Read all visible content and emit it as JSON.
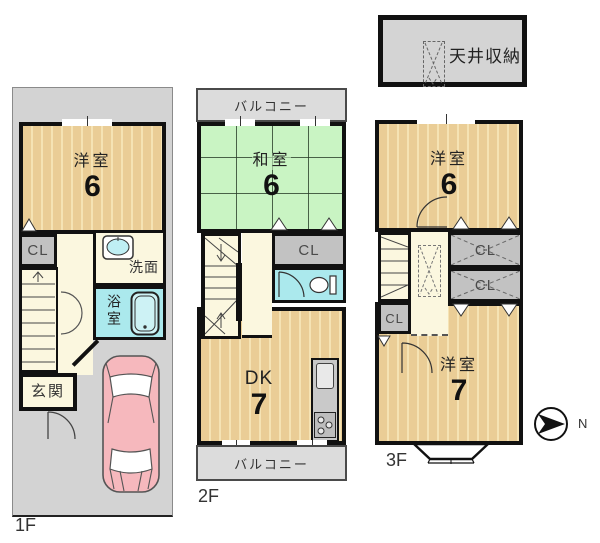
{
  "f1": {
    "label": "1F",
    "western_room": {
      "name": "洋室",
      "size": "6"
    },
    "closet": "CL",
    "washroom": "洗面",
    "bathroom": "浴室",
    "entrance": "玄関"
  },
  "f2": {
    "label": "2F",
    "balcony_top": "バルコニー",
    "balcony_bottom": "バルコニー",
    "tatami_room": {
      "name": "和室",
      "size": "6"
    },
    "closet": "CL",
    "dining_kitchen": {
      "name": "DK",
      "size": "7"
    }
  },
  "f3": {
    "label": "3F",
    "western_room_6": {
      "name": "洋室",
      "size": "6"
    },
    "closet_right_1": "CL",
    "closet_right_2": "CL",
    "closet_left": "CL",
    "western_room_7": {
      "name": "洋室",
      "size": "7"
    }
  },
  "attic_storage": {
    "label": "天井収納"
  },
  "compass": {
    "north": "N"
  },
  "colors": {
    "wall": "#111111",
    "lot_gray": "#d3d3d3",
    "room_tan": "#eacd96",
    "tatami_green": "#c9f4c3",
    "hall_cream": "#fbf7df",
    "water_cyan": "#abe9ed",
    "closet_gray": "#c2c2c2",
    "balcony_gray": "#dcdcdc",
    "car_pink": "#f6b8bd"
  }
}
